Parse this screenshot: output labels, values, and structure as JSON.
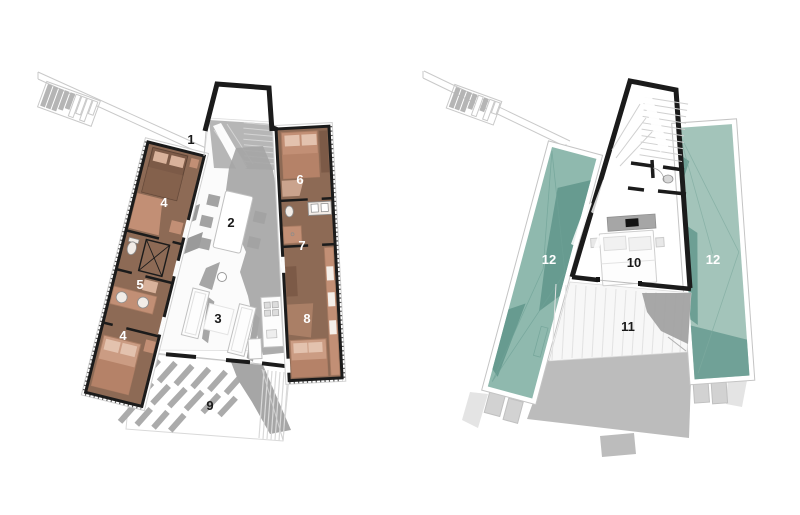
{
  "canvas": {
    "width": 800,
    "height": 515,
    "background": "#ffffff"
  },
  "palette": {
    "wall_black": "#1b1b1b",
    "room_brown": "#8d6a55",
    "bed_brown_dark": "#7c5a47",
    "furniture_salmon": "#c28f75",
    "furniture_salmon_light": "#d9b29b",
    "blanket_salmon_dark": "#b58268",
    "bed_salmon": "#cb9c83",
    "floor_gray": "#b3b3b3",
    "shadow_gray": "#a6a6a6",
    "green_roof": "#8fb9ae",
    "green_roof_light": "#a3c4ba",
    "green_roof_shadow": "#679b90",
    "label_dark": "#1a1a1a",
    "label_light": "#ffffff"
  },
  "ground_floor": {
    "rooms": {
      "r1": "1",
      "r2": "2",
      "r3": "3",
      "r4": "4",
      "r5": "5",
      "r6": "6",
      "r7": "7",
      "r8": "8",
      "r9": "9"
    }
  },
  "upper_floor": {
    "rooms": {
      "r10": "10",
      "r11": "11",
      "r12": "12"
    }
  }
}
